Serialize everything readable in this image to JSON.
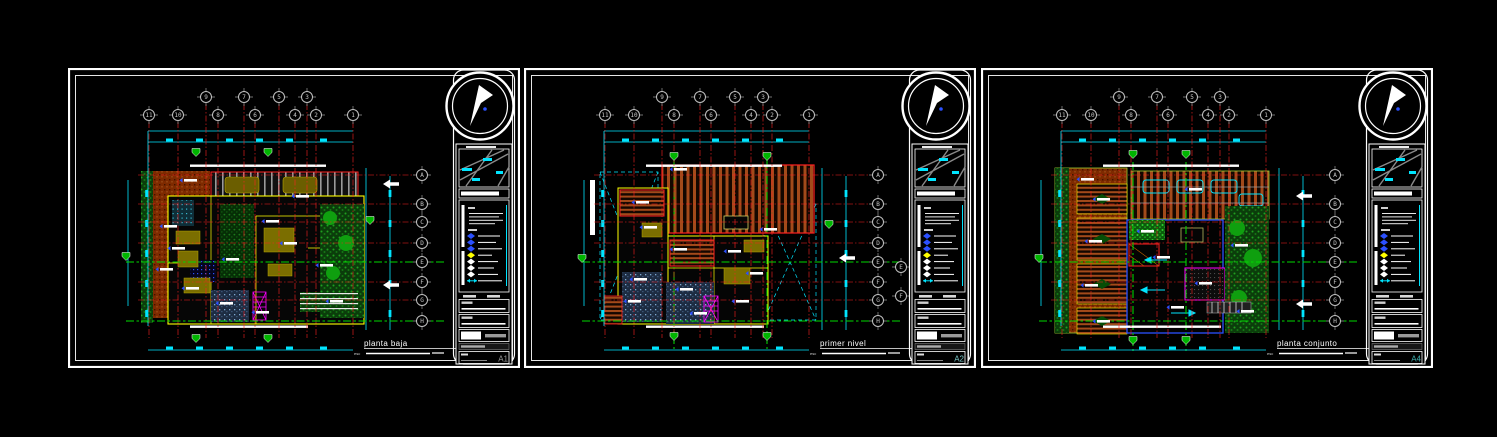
{
  "app": {
    "background": "#000000"
  },
  "sheets": [
    {
      "name": "sheet-1",
      "plan_label": {
        "title": "planta baja",
        "scale_prefix": "esc"
      },
      "sheet_number": "A1",
      "sheet_number_color": "#9a9a9a",
      "grid": {
        "top_upper": [
          "9",
          "7",
          "5",
          "3"
        ],
        "top_lower": [
          "11",
          "10",
          "8",
          "6",
          "4",
          "2",
          "1"
        ],
        "right": [
          "A",
          "B",
          "C",
          "D",
          "E",
          "F",
          "G",
          "H"
        ],
        "right_offset": []
      }
    },
    {
      "name": "sheet-2",
      "plan_label": {
        "title": "primer nivel",
        "scale_prefix": "esc"
      },
      "sheet_number": "A2",
      "sheet_number_color": "#79c7c7",
      "grid": {
        "top_upper": [
          "9",
          "7",
          "5",
          "3"
        ],
        "top_lower": [
          "11",
          "10",
          "8",
          "6",
          "4",
          "2",
          "1"
        ],
        "right": [
          "A",
          "B",
          "C",
          "D",
          "E",
          "F",
          "G",
          "H"
        ],
        "right_offset": [
          "E",
          "F"
        ]
      }
    },
    {
      "name": "sheet-3",
      "plan_label": {
        "title": "planta conjunto",
        "scale_prefix": "esc"
      },
      "sheet_number": "A4",
      "sheet_number_color": "#3fb0b0",
      "grid": {
        "top_upper": [
          "9",
          "7",
          "5",
          "3"
        ],
        "top_lower": [
          "11",
          "10",
          "8",
          "6",
          "4",
          "2",
          "1"
        ],
        "right": [
          "A",
          "B",
          "C",
          "D",
          "E",
          "F",
          "G",
          "H"
        ],
        "right_offset": []
      }
    }
  ],
  "legend": {
    "symbol_colors": [
      "#2b50ff",
      "#2b50ff",
      "#2b50ff",
      "#ffff00",
      "#ffffff",
      "#ffffff",
      "#ffffff",
      "#00e5ff"
    ]
  },
  "colors": {
    "background": "#000000",
    "frame": "#ffffff",
    "dimension": "#00e5ff",
    "axis_grid": "#ff2020",
    "section_line": "#00d800",
    "walls": "#ffff00",
    "vegetation": "#1e8f1e",
    "pavement": "#8a3000",
    "roof": "#a34a1a",
    "furniture": "#7b6e00",
    "stair": "#ff00ff",
    "marker_green": "#00b400",
    "label_arrow_blue": "#2b50ff"
  }
}
